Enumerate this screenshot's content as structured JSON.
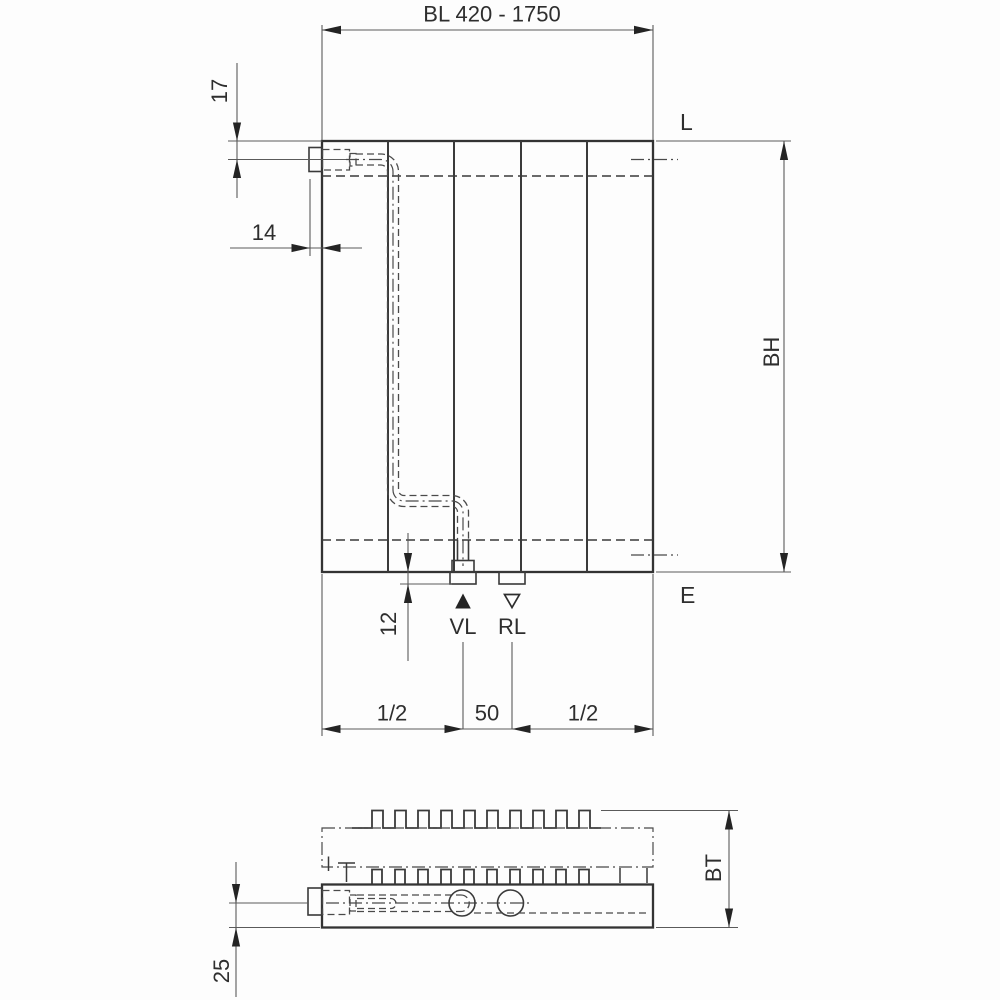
{
  "colors": {
    "background": "#fdfdfd",
    "outline": "#333333",
    "dimension_line": "#5a5a5a",
    "text": "#2e2e2e"
  },
  "front_view": {
    "width_dim": "BL 420 - 1750",
    "top_offset_dim": "17",
    "side_offset_dim": "14",
    "vent_label": "L",
    "height_dim": "BH",
    "drain_label": "E",
    "tail_dim": "12",
    "supply_label": "VL",
    "return_label": "RL",
    "left_span_dim": "1/2",
    "center_span_dim": "50",
    "right_span_dim": "1/2"
  },
  "top_view": {
    "depth_dim": "BT",
    "pipe_offset_dim": "25"
  }
}
